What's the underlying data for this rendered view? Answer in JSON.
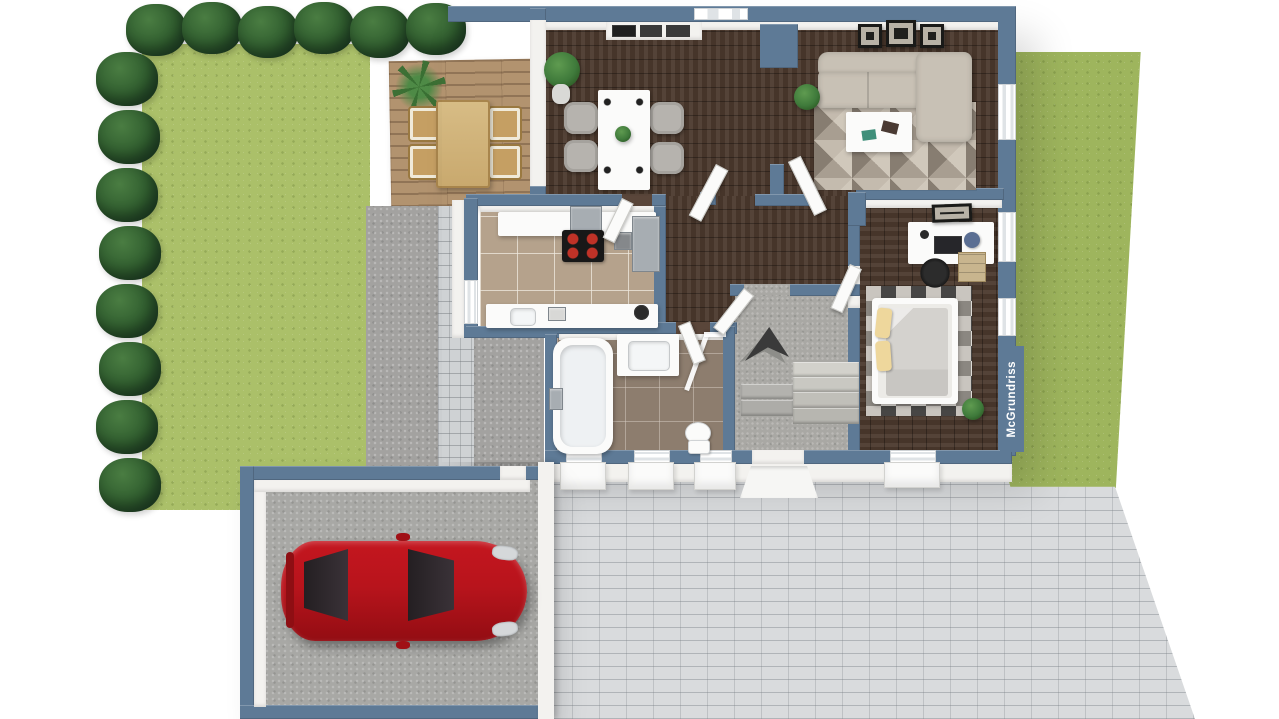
{
  "scene": {
    "type": "3d-floor-plan-render",
    "watermark": "McGrundriss"
  },
  "palette": {
    "wall": "#5e7a96",
    "whiteFace": "#f3f2ef",
    "lawn": "#abc069",
    "lawnRight": "#9eb55d",
    "hedge": "#2f5c2e",
    "wood": "#4b392d",
    "deck": "#b2936f",
    "kitchenTile": "#b5a28c",
    "bathTile": "#8d7d6e",
    "concrete": "#a3a2a0",
    "paver": "#d9dbdd",
    "carBody": "#b8141c",
    "sofa": "#c8c1b5",
    "pillow": "#eed79c",
    "duvet": "#d4d2ce",
    "plant": "#3f7a3b",
    "appliance": "#1f1f1f",
    "steel": "#a7adb2",
    "burner": "#c03227",
    "arrow": "#3a3a3a"
  },
  "legend": {
    "areas": [
      "garden",
      "terrace",
      "dining-area",
      "living-room",
      "kitchen",
      "bathroom",
      "hallway",
      "entry-stairs",
      "bedroom-office",
      "garage",
      "patio"
    ]
  }
}
